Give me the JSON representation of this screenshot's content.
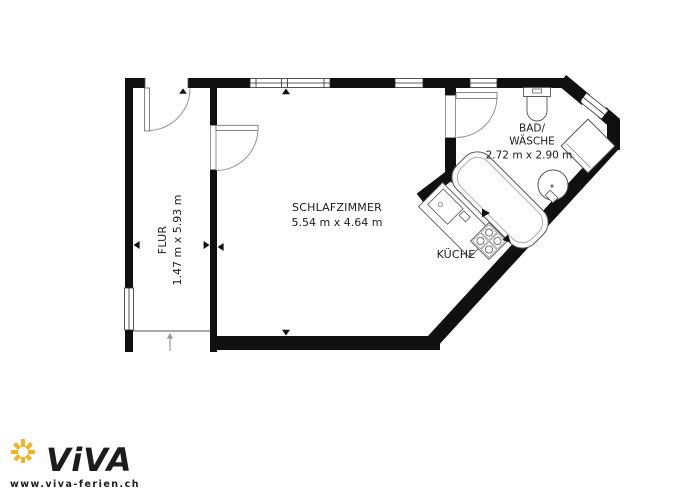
{
  "plan": {
    "schlafzimmer": {
      "label": "SCHLAFZIMMER",
      "dims": "5.54 m x 4.64 m"
    },
    "flur": {
      "label": "FLUR",
      "dims": "1.47 m x 5.93 m"
    },
    "bad": {
      "label_line1": "BAD/",
      "label_line2": "WÄSCHE",
      "dims": "2.72 m x 2.90 m"
    },
    "kueche": {
      "label": "KÜCHE"
    }
  },
  "branding": {
    "logo_text": "ViVA",
    "website": "www.viva-ferien.ch",
    "navy": "#1d4a7d",
    "yellow": "#f0b429"
  },
  "colors": {
    "wall": "#101010",
    "fixture_stroke": "#555555"
  }
}
